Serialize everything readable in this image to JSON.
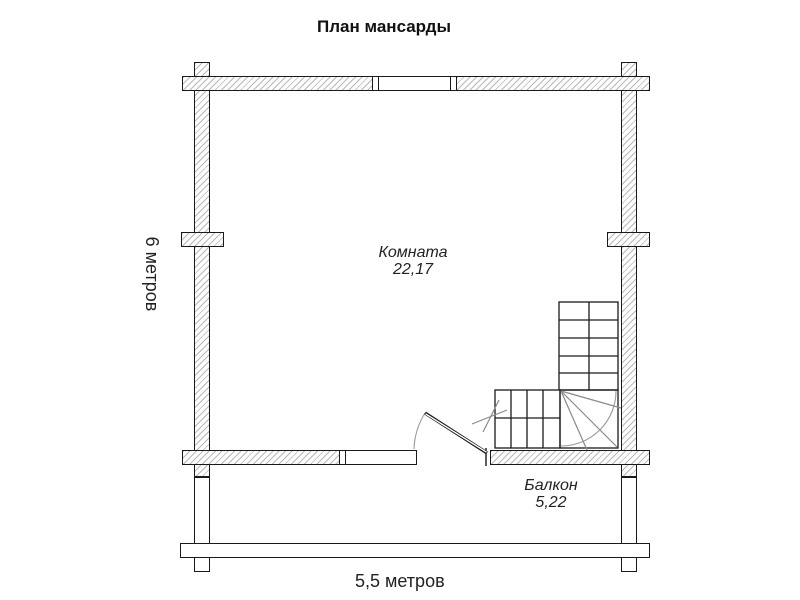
{
  "title": "План мансарды",
  "rooms": {
    "room": {
      "label": "Комната",
      "area": "22,17"
    },
    "balcony": {
      "label": "Балкон",
      "area": "5,22"
    }
  },
  "dimensions": {
    "vertical": "6 метров",
    "horizontal": "5,5 метров"
  },
  "colors": {
    "line": "#1a1a1a",
    "hatch": "#828282",
    "thin_detail": "#888888",
    "background": "#ffffff"
  }
}
